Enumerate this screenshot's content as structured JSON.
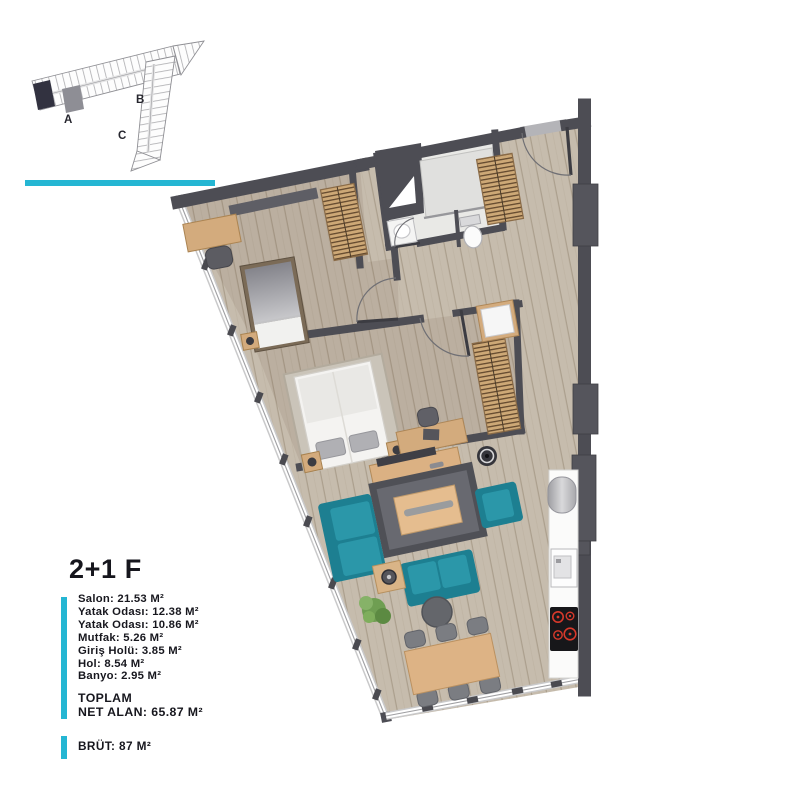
{
  "palette": {
    "accent": "#25b6d3",
    "wall": "#4d4d54",
    "sofa_teal": "#2b93a5",
    "wood": "#d3ab7d",
    "floor": "#c6bcad",
    "burner_red": "#d8392b",
    "text": "#17171e"
  },
  "key_plan": {
    "block_labels": [
      "A",
      "B",
      "C"
    ]
  },
  "info": {
    "title": "2+1 F",
    "rooms": [
      "Salon: 21.53 M²",
      "Yatak Odası: 12.38 M²",
      "Yatak Odası: 10.86 M²",
      "Mutfak: 5.26 M²",
      "Giriş Holü: 3.85 M²",
      "Hol: 8.54 M²",
      "Banyo: 2.95 M²"
    ],
    "total_label": "TOPLAM",
    "net_area": "NET ALAN: 65.87 M²",
    "brut": "BRÜT: 87 M²"
  }
}
